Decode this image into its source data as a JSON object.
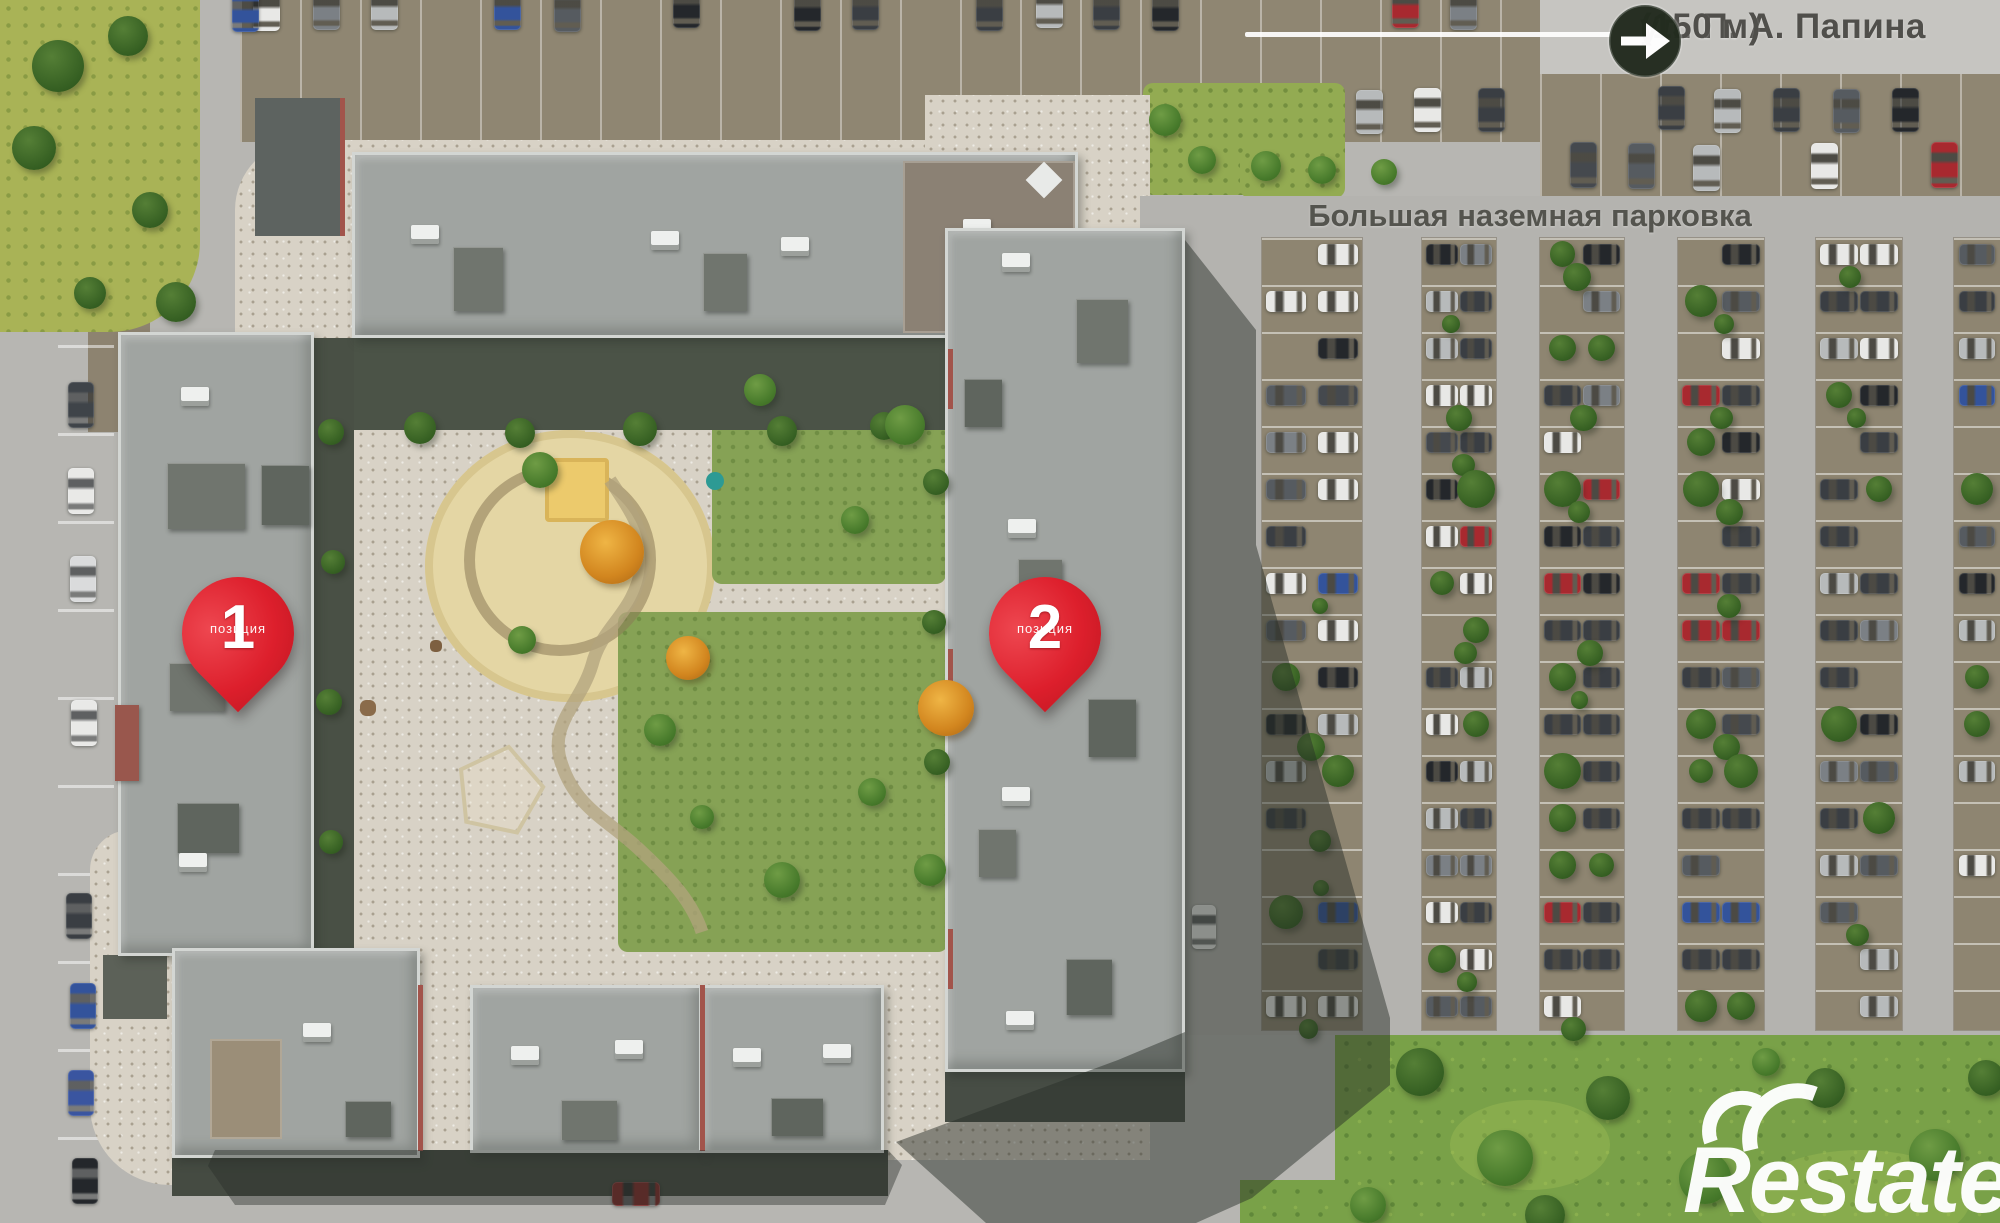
{
  "street_sign": {
    "street": "ул. П. А. Папина",
    "distance": "(150 м)"
  },
  "parking_label": "Большая наземная парковка",
  "pins": [
    {
      "number": "1",
      "caption": "позиция"
    },
    {
      "number": "2",
      "caption": "позиция"
    }
  ],
  "watermark": "Restate",
  "colors": {
    "pin_red": "#dd1f2c",
    "roof_gray": "#a0a4a1",
    "plaza_beige": "#d8d2c6",
    "parking_brown": "#8f8672",
    "road_gray": "#b7b6b2",
    "grass_green": "#79a148",
    "shadow": "rgba(40,46,40,0.48)",
    "label_text": "#4c4c46",
    "watermark_white": "#ffffff"
  }
}
